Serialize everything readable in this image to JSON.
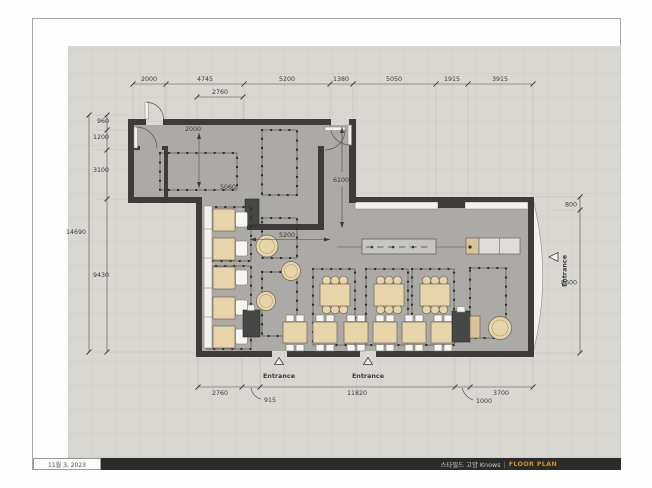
{
  "sheet": {
    "date": "11월 3, 2023",
    "title_ko": "스타필드 고양 Knows",
    "separator": "|",
    "doc_type": "FLOOR PLAN",
    "accent_color": "#cf8d2c"
  },
  "dimensions": {
    "top": [
      "2000",
      "4745",
      "5200",
      "1380",
      "5050",
      "1915",
      "3915"
    ],
    "top_secondary": "2760",
    "left_overall": "14690",
    "left": [
      "960",
      "1200",
      "3100",
      "9430"
    ],
    "right": [
      "800",
      "8600"
    ],
    "bottom": [
      "2760",
      "11820",
      "3700"
    ],
    "bottom_leaders": [
      "915",
      "1000"
    ],
    "interior": {
      "kitchen_depth": "2000",
      "island": "5060",
      "hall": "6100",
      "bay": "5200"
    }
  },
  "labels": {
    "entrance_right": "Entrance",
    "entrance_bottom_1": "Entrance",
    "entrance_bottom_2": "Entrance"
  }
}
